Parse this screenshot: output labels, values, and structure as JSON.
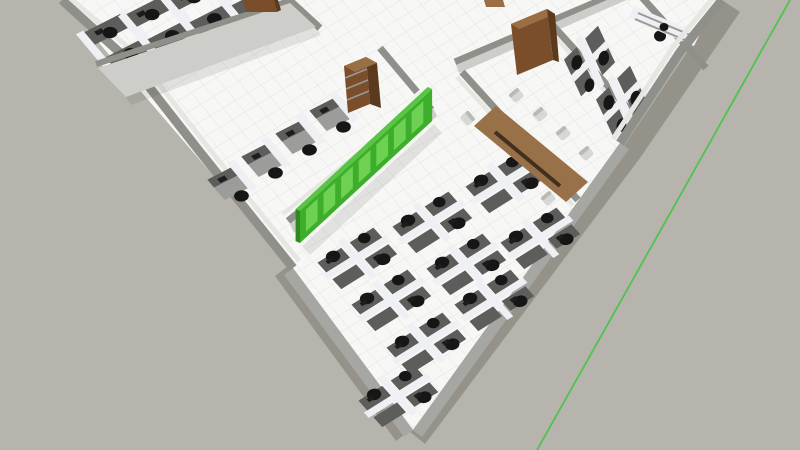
{
  "viewport": {
    "type": "3d-model-viewport",
    "view": "isometric office floor plan, camera looking down at building corner",
    "visible_ui_text": "none"
  },
  "colors": {
    "bg": "#b6b4ac",
    "floor": "#f7f7f5",
    "grid": "#e3e3e0",
    "wall_band": "#90908b",
    "wall_face_light": "#e6e6e3",
    "wall_face_mid": "#cdcdca",
    "slab": "#a6a6a2",
    "shadow": "rgba(72,68,56,0.30)",
    "soft_shadow": "rgba(40,40,34,0.10)",
    "green_face": "#3cae2b",
    "green_top": "#58c544",
    "green_cap": "#2d8a1f",
    "green_panel": "#6ed152",
    "rail": "#eef0f3",
    "desk_dark": "#5d5d5b",
    "desk_mid": "#9c9c9a",
    "chair_black": "#161616",
    "chair_gray": "#d7d7d4",
    "chair_gray_dark": "#b9b9b5",
    "wood_front": "#7a4e2a",
    "wood_side": "#5c3a1e",
    "wood_top": "#9a6f46",
    "table_top": "#997149",
    "table_groove": "#42301e",
    "shelf_slat": "#9a9a96",
    "monitor": "#1c1c1c",
    "axis_green": "#50c24e"
  },
  "scene": {
    "description": "Open-plan office 3D model: two wings of rooms meeting at a corner pointing toward the viewer, open cubicle field in the middle, green panel partition, conference room, storage shelves; green model axis line over plain ground",
    "rooms": [
      {
        "id": "room-top-left",
        "type": "cubicle-office",
        "cubicle_pods": 4,
        "chairs": 8
      },
      {
        "id": "room-mid-left",
        "type": "workstation-row",
        "workstations": 4,
        "furniture": [
          "bookshelf"
        ]
      },
      {
        "id": "open-plan-center",
        "type": "cubicle-field",
        "cubicle_pods": 9,
        "furniture": [
          "green-partition-wall"
        ]
      },
      {
        "id": "conference-room",
        "type": "meeting-room",
        "chairs": 6,
        "furniture": [
          "conference-table",
          "storage-cabinet"
        ]
      },
      {
        "id": "room-right-cubicles",
        "type": "cubicle-office",
        "cubicle_pods": 2,
        "chairs": 8
      },
      {
        "id": "room-top-right",
        "type": "storage",
        "furniture": [
          "shelving-units"
        ]
      }
    ],
    "green_partition": {
      "panels": 7
    },
    "axis_line": {
      "axis": "green-y-axis",
      "from_top_x": 790,
      "to_bottom_x": 537
    }
  }
}
